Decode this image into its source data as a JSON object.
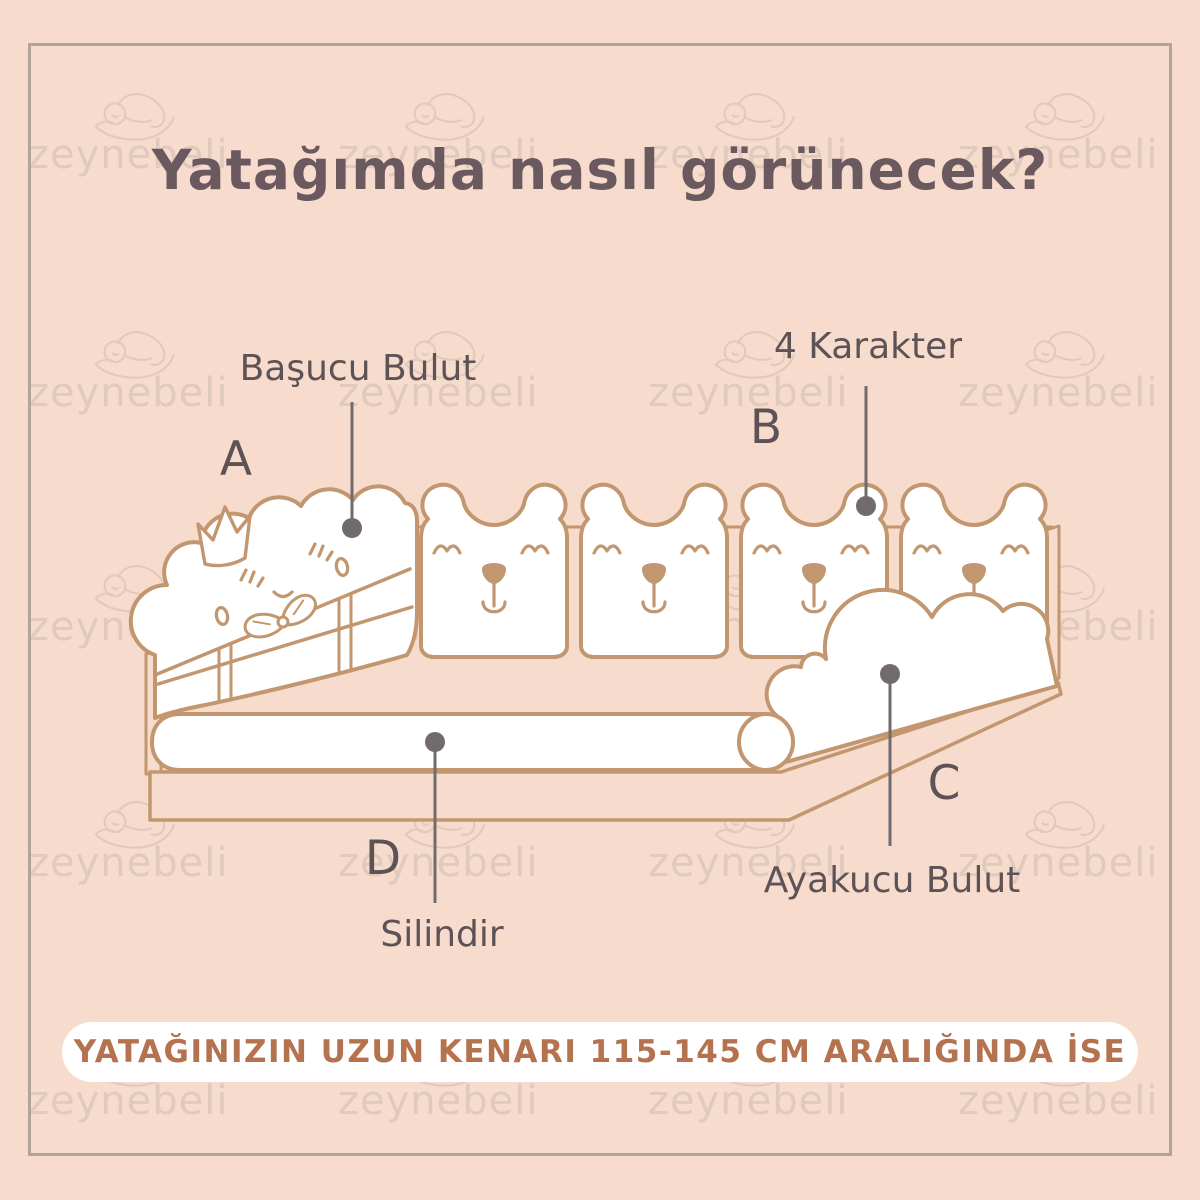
{
  "title": "Yatağımda nasıl görünecek?",
  "watermark": {
    "text": "zeynebeli"
  },
  "diagram": {
    "parts": [
      {
        "letter": "A",
        "name": "Başucu Bulut"
      },
      {
        "letter": "B",
        "name": "4 Karakter"
      },
      {
        "letter": "C",
        "name": "Ayakucu Bulut"
      },
      {
        "letter": "D",
        "name": "Silindir"
      }
    ],
    "character_count": 4
  },
  "banner": {
    "text": "YATAĞINIZIN UZUN KENARI 115-145 CM ARALIĞINDA İSE"
  },
  "colors": {
    "background": "#f7dccd",
    "line_art": "#c2966e",
    "leader": "#716b6d",
    "label_text": "#5d5356",
    "title_text": "#6b5960",
    "banner_text": "#b5724e",
    "banner_bg": "#ffffff",
    "border": "#b3a49b",
    "watermark": "#e0c9bd"
  }
}
